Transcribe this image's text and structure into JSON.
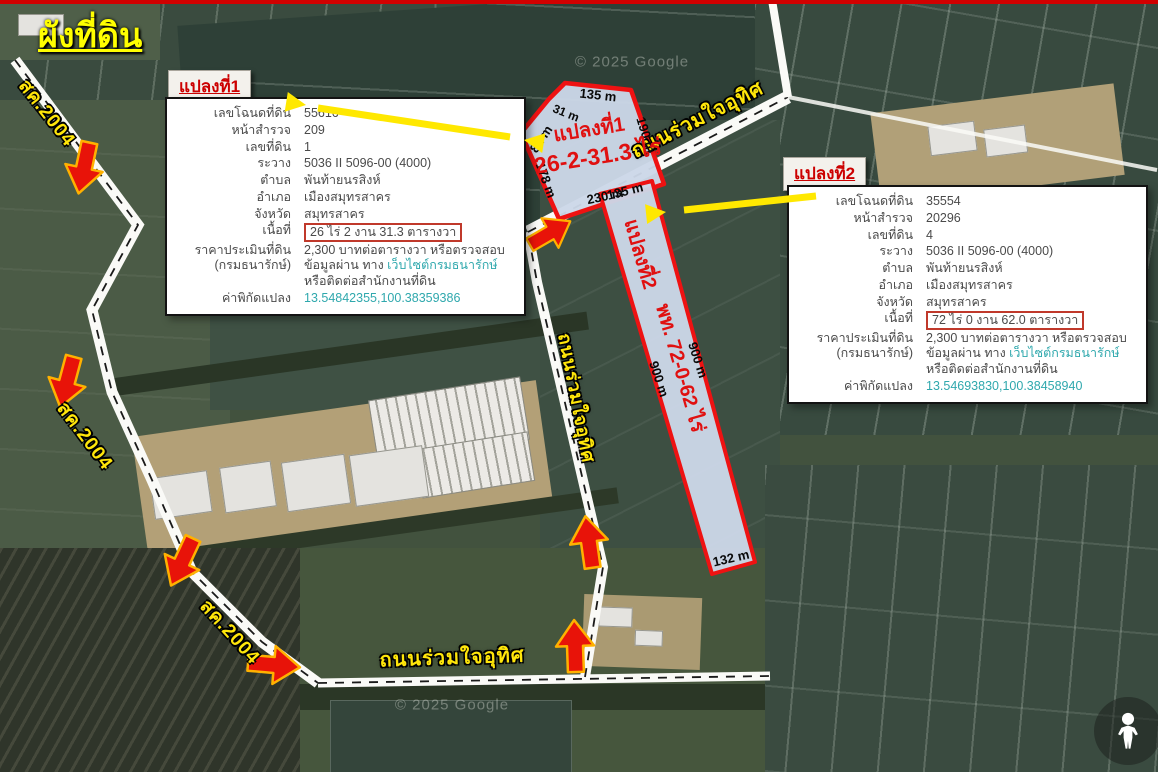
{
  "page": {
    "title": "ผังที่ดิน",
    "watermark": "© 2025 Google"
  },
  "colors": {
    "plot_outline": "#ee1212",
    "plot_fill": "#ccd7e8",
    "highlight_yellow": "#ffe600",
    "arrow_red": "#e81309",
    "arrow_edge_orange": "#ffb100",
    "link_teal": "#2fa8ad",
    "label_red": "#cc0000",
    "road_white": "#fafaf7"
  },
  "plots_map": {
    "plot1_name": "แปลงที่1",
    "plot1_area": "26-2-31.3 ไร่",
    "plot2_name": "แปลงที่2",
    "plot2_area": "พท. 72-0-62 ไร่",
    "dims": {
      "d135": "135 m",
      "d31": "31 m",
      "d82": "82 m",
      "d178": "178 m",
      "d190": "190 m",
      "d230": "230 m",
      "d900": "900 m",
      "d132": "132 m"
    },
    "road_main": "ถนนร่วมใจอุทิศ",
    "road_side": "สค.2004"
  },
  "box1": {
    "tab": "แปลงที่1",
    "rows": [
      {
        "label": "เลขโฉนดที่ดิน",
        "value": "55616"
      },
      {
        "label": "หน้าสำรวจ",
        "value": "209"
      },
      {
        "label": "เลขที่ดิน",
        "value": "1"
      },
      {
        "label": "ระวาง",
        "value": "5036 II 5096-00 (4000)"
      },
      {
        "label": "ตำบล",
        "value": "พันท้ายนรสิงห์"
      },
      {
        "label": "อำเภอ",
        "value": "เมืองสมุทรสาคร"
      },
      {
        "label": "จังหวัด",
        "value": "สมุทรสาคร"
      }
    ],
    "area_label": "เนื้อที่",
    "area_value": "26 ไร่ 2 งาน 31.3 ตารางวา",
    "price_label1": "ราคาประเมินที่ดิน",
    "price_label2": "(กรมธนารักษ์)",
    "price_pre": "2,300 บาทต่อตารางวา หรือตรวจสอบข้อมูลผ่าน ทาง ",
    "price_link": "เว็บไซต์กรมธนารักษ์",
    "price_post": " หรือติดต่อสำนักงานที่ดิน",
    "coord_label": "ค่าพิกัดแปลง",
    "coord_value": "13.54842355,100.38359386"
  },
  "box2": {
    "tab": "แปลงที่2",
    "rows": [
      {
        "label": "เลขโฉนดที่ดิน",
        "value": "35554"
      },
      {
        "label": "หน้าสำรวจ",
        "value": "20296"
      },
      {
        "label": "เลขที่ดิน",
        "value": "4"
      },
      {
        "label": "ระวาง",
        "value": "5036 II 5096-00 (4000)"
      },
      {
        "label": "ตำบล",
        "value": "พันท้ายนรสิงห์"
      },
      {
        "label": "อำเภอ",
        "value": "เมืองสมุทรสาคร"
      },
      {
        "label": "จังหวัด",
        "value": "สมุทรสาคร"
      }
    ],
    "area_label": "เนื้อที่",
    "area_value": "72 ไร่ 0 งาน 62.0 ตารางวา",
    "price_label1": "ราคาประเมินที่ดิน",
    "price_label2": "(กรมธนารักษ์)",
    "price_pre": "2,300 บาทต่อตารางวา หรือตรวจสอบข้อมูลผ่าน ทาง ",
    "price_link": "เว็บไซต์กรมธนารักษ์",
    "price_post": " หรือติดต่อสำนักงานที่ดิน",
    "coord_label": "ค่าพิกัดแปลง",
    "coord_value": "13.54693830,100.38458940"
  }
}
